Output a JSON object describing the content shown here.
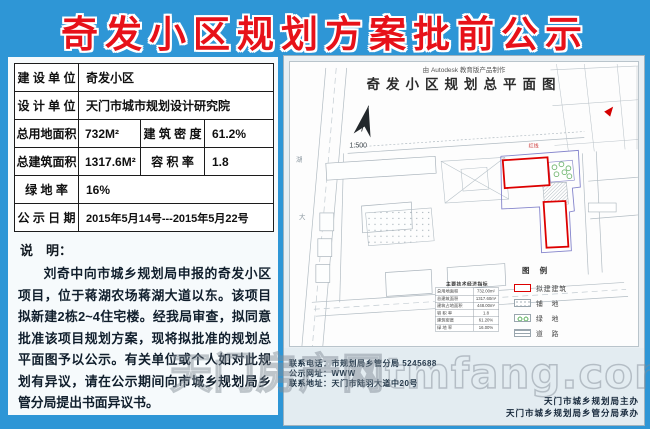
{
  "page_title": "奇发小区规划方案批前公示",
  "info": {
    "r1": {
      "label": "建 设 单 位",
      "value": "奇发小区"
    },
    "r2": {
      "label": "设 计 单 位",
      "value": "天门市城市规划设计研究院"
    },
    "r3": {
      "label": "总用地面积",
      "value": "732M²",
      "label2": "建 筑 密 度",
      "value2": "61.2%"
    },
    "r4": {
      "label": "总建筑面积",
      "value": "1317.6M²",
      "label2": "容 积 率",
      "value2": "1.8"
    },
    "r5": {
      "label": "绿  地  率",
      "value": "16%"
    },
    "r6": {
      "label": "公 示 日 期",
      "value": "2015年5月14号---2015年5月22号"
    },
    "note_heading": "说　明：",
    "note_text": "刘奇中向市城乡规划局申报的奇发小区项目，位于蒋湖农场蒋湖大道以东。该项目拟新建2栋2~4住宅楼。经我局审查，拟同意批准该项目规划方案，现将拟批准的规划总平面图予以公示。有关单位或个人如对此规划有异议，请在公示期间向市城乡规划局乡管分局提出书面异议书。"
  },
  "plan": {
    "credit": "由 Autodesk 教育版产品制作",
    "title": "奇发小区规划总平面图",
    "scale": "1:500",
    "road_chars": [
      "湖",
      "大"
    ],
    "redline_label": "红线",
    "indicators": {
      "title": "主要技术经济指标",
      "rows": [
        {
          "name": "总用地面积",
          "value": "732.00m²"
        },
        {
          "name": "总建筑面积",
          "value": "1317.60m²"
        },
        {
          "name": "建筑占地面积",
          "value": "448.00m²"
        },
        {
          "name": "容 积 率",
          "value": "1.8"
        },
        {
          "name": "建筑密度",
          "value": "61.20%"
        },
        {
          "name": "绿 地 率",
          "value": "16.00%"
        }
      ]
    },
    "legend": {
      "title": "图 例",
      "items": [
        {
          "label": "拟建建筑"
        },
        {
          "label": "铺　地"
        },
        {
          "label": "绿　地"
        },
        {
          "label": "道　路"
        }
      ]
    }
  },
  "contact": {
    "phone_line": "联系电话：市规划局乡管分局 5245688",
    "web_line": "公示网址：WWW",
    "addr_line": "联系地址：天门市陆羽大道中20号",
    "host_line": "天门市城乡规划局主办",
    "organizer_line": "天门市城乡规划局乡管分局承办"
  },
  "watermark": "天门房产网tmfang.com",
  "colors": {
    "background": "#2e96d6",
    "title_red": "#e71119",
    "proposed_red": "#dd0000",
    "boundary_blue": "#8484cc",
    "tree_green": "#74b874"
  }
}
